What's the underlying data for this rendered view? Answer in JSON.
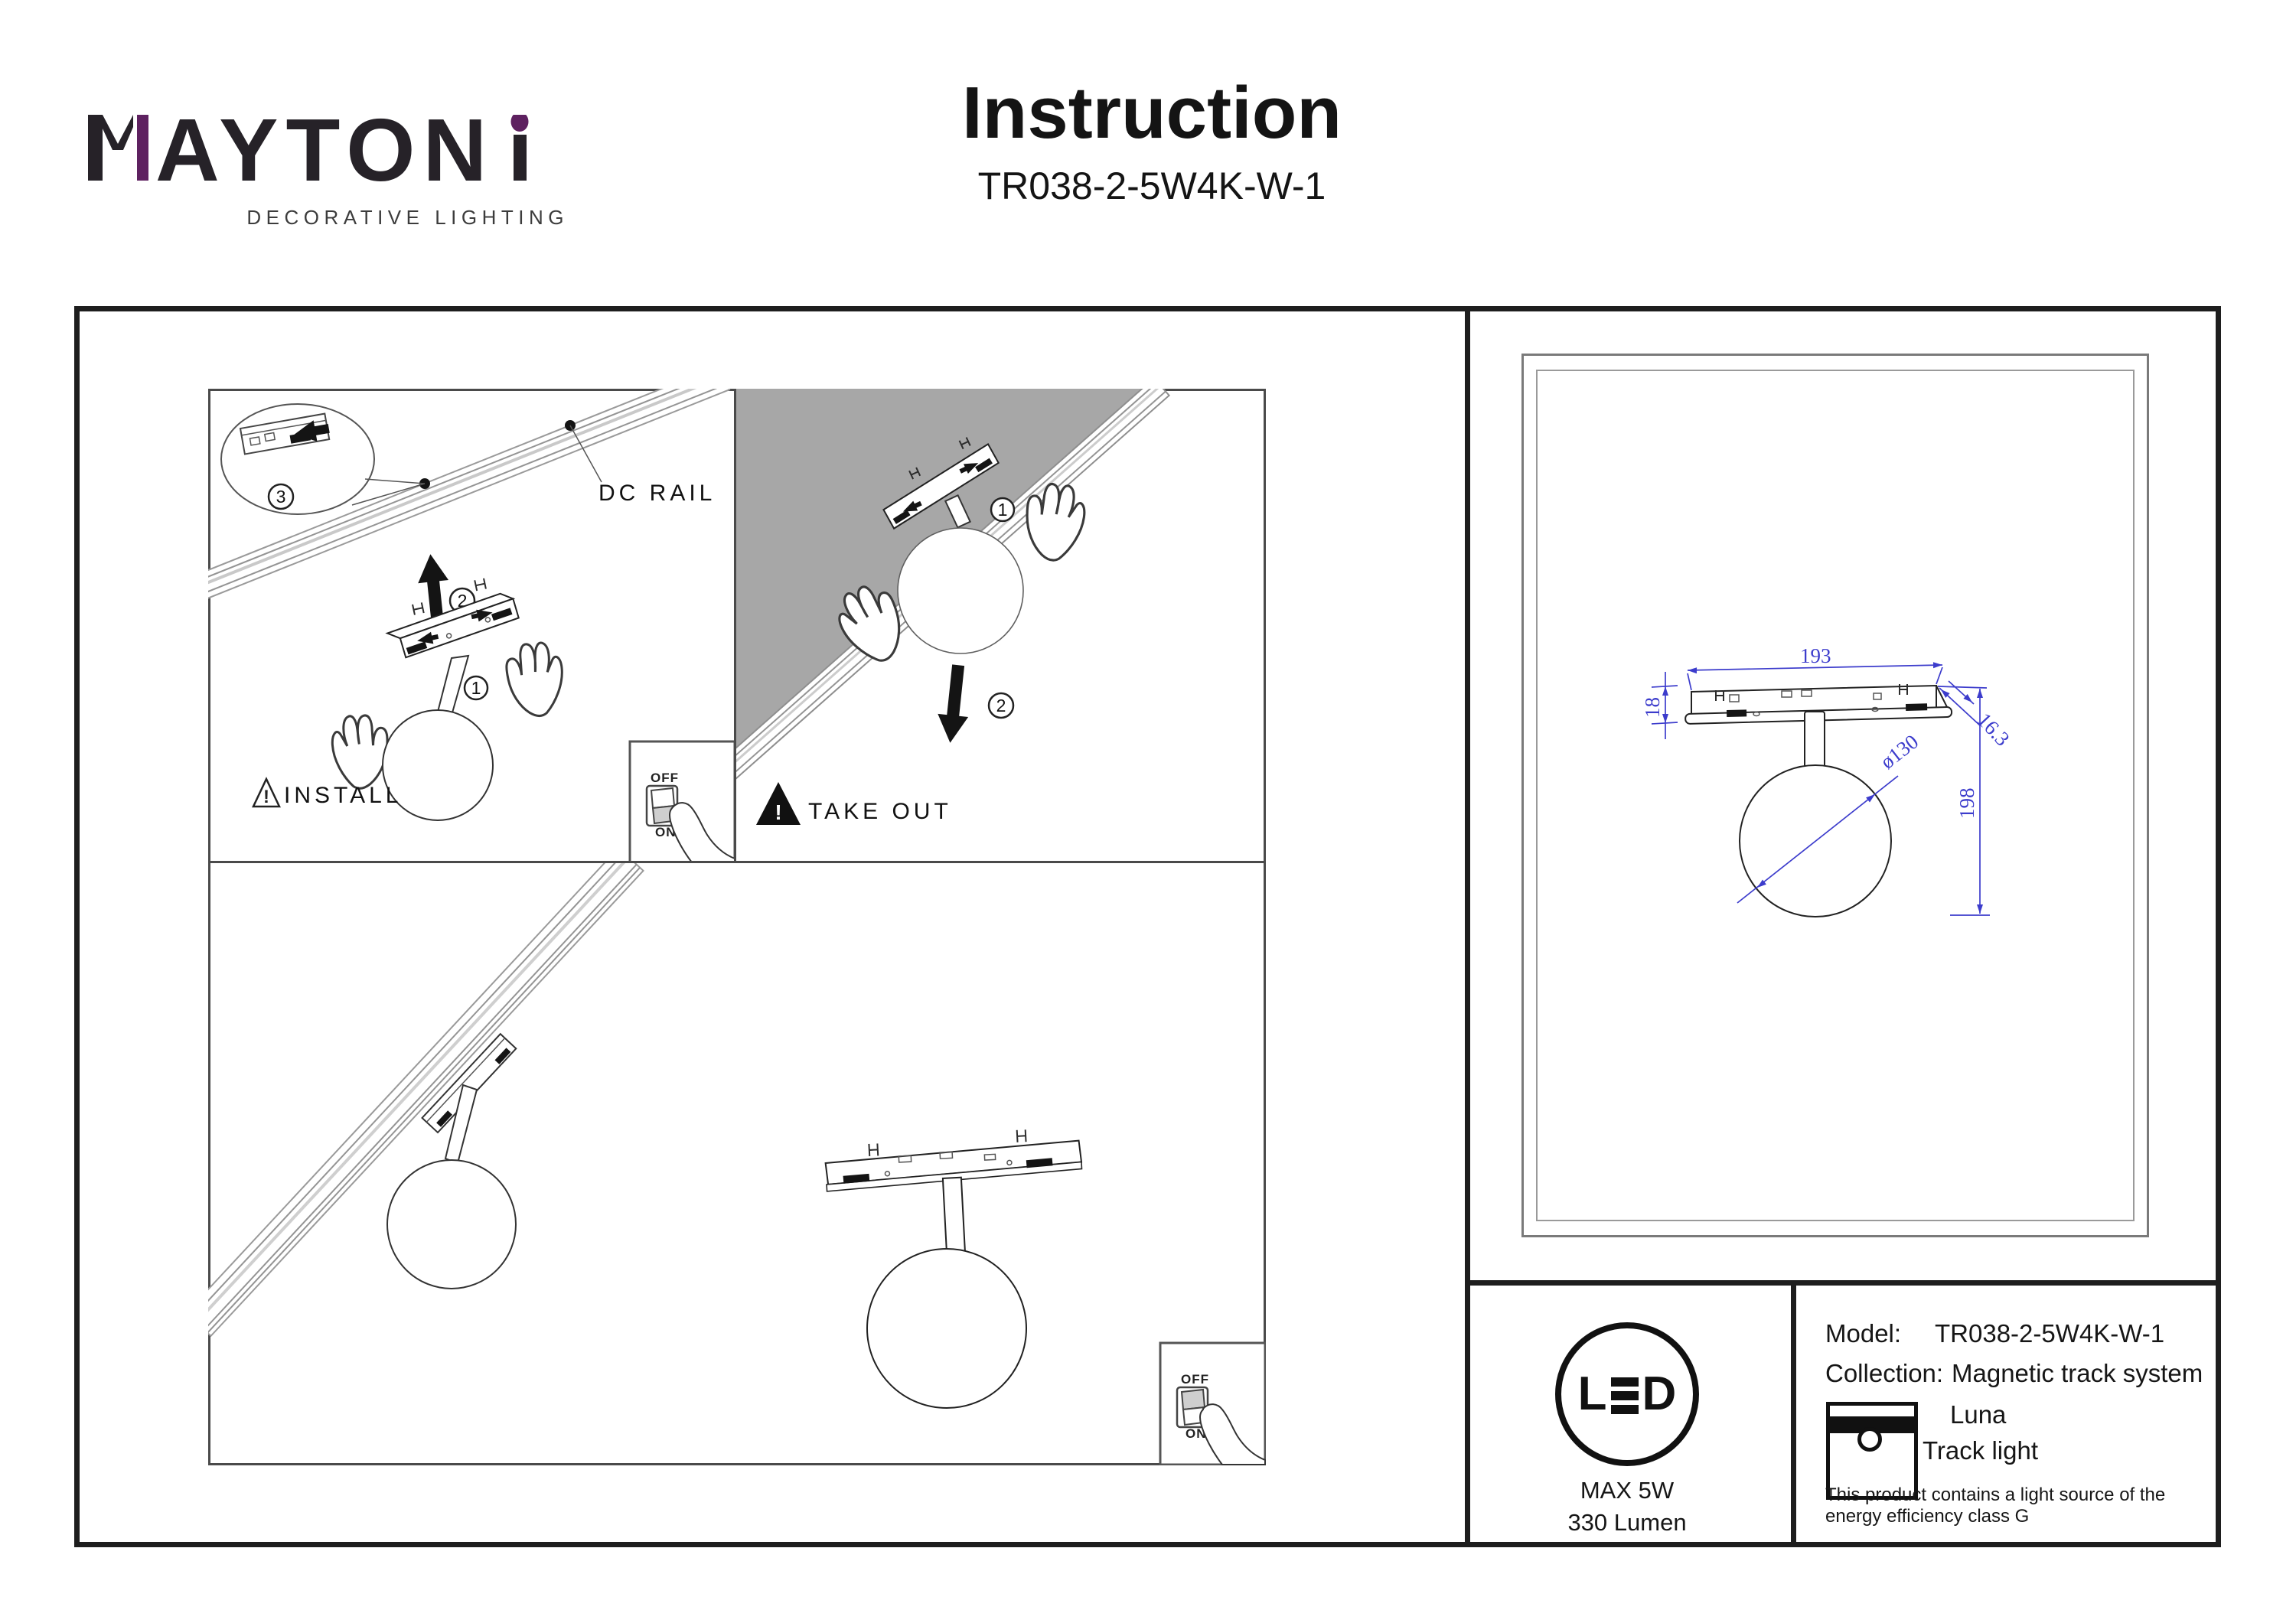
{
  "brand": {
    "logo_text": "MAYTONI",
    "logo_mid": "AYTON",
    "tagline": "DECORATIVE LIGHTING",
    "accent_color": "#5e2160"
  },
  "header": {
    "title": "Instruction",
    "model_code": "TR038-2-5W4K-W-1"
  },
  "diagram": {
    "install": {
      "caption": "INSTALL",
      "warning_mark": "!",
      "rail_label": "DC RAIL",
      "step1": "1",
      "step2": "2",
      "step3": "3",
      "switch_off": "OFF",
      "switch_on": "ON"
    },
    "take_out": {
      "caption": "TAKE OUT",
      "warning_mark": "!",
      "step1": "1",
      "step2": "2",
      "ceiling_color": "#a7a7a7"
    },
    "result": {
      "switch_off": "OFF",
      "switch_on": "ON"
    }
  },
  "tech_drawing": {
    "dim_color": "#3c3ccc",
    "width": "193",
    "track_height": "18",
    "track_depth": "16.3",
    "globe_diameter": "ø130",
    "total_height": "198"
  },
  "spec_panel": {
    "led": {
      "letter_l": "L",
      "letter_d": "D",
      "max_power": "MAX 5W",
      "luminous_flux": "330 Lumen"
    },
    "rows": {
      "model_label": "Model:",
      "model_value": "TR038-2-5W4K-W-1",
      "collection_label": "Collection:",
      "collection_value": "Magnetic track system"
    },
    "collection_name": "Luna",
    "product_type": "Track light",
    "energy_note_line1": "This product contains a light source of the",
    "energy_note_line2": "energy efficiency class G"
  }
}
